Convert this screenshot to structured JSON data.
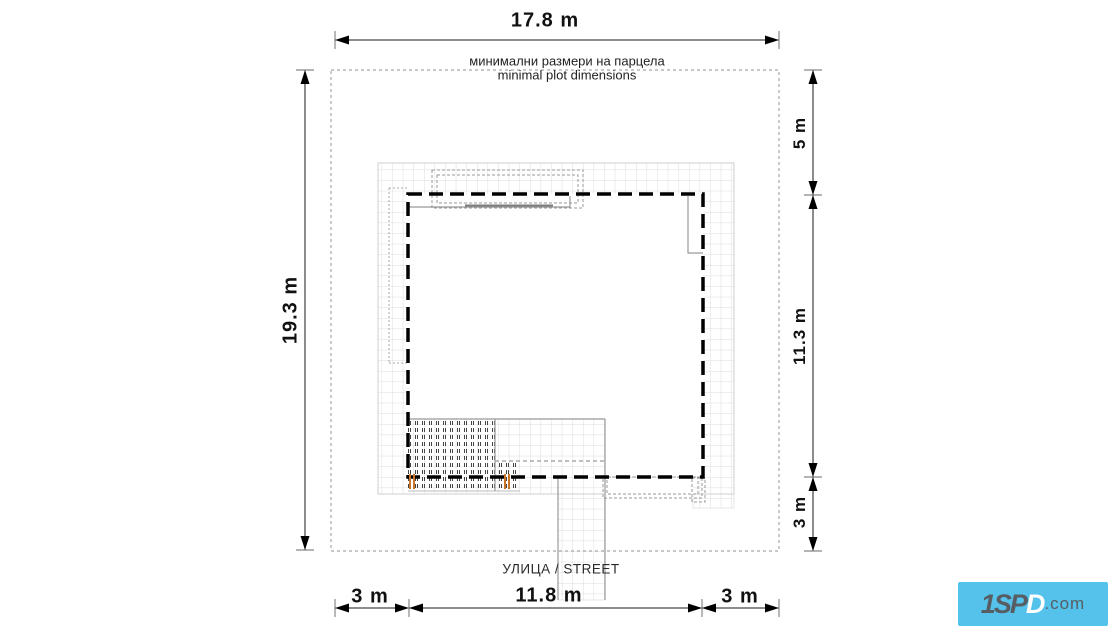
{
  "header": {
    "top_dimension": "17.8 m",
    "note_bg": "минимални размери на парцела",
    "note_en": "minimal plot dimensions"
  },
  "dimensions": {
    "left": "19.3 m",
    "right_top": "5 m",
    "right_middle": "11.3 m",
    "right_bottom": "3 m",
    "bottom_left": "3 m",
    "bottom_middle": "11.8 m",
    "bottom_right": "3 m"
  },
  "street_label": "УЛИЦА / STREET",
  "watermark": {
    "logo_main": "1SP",
    "logo_d": "D",
    "logo_suffix": ".com",
    "bg_color": "#54c2eb",
    "text_color": "#575d63",
    "accent_color": "#ffffff"
  },
  "colors": {
    "envelope_line": "#000000",
    "plot_boundary": "#a8a8a8",
    "grid_line": "#dcdcdc",
    "house_line": "#999999",
    "deck_hatch": "#444444",
    "accent_marks": "#c8762c",
    "dimension_line": "#1a1a1a",
    "dimension_tick": "#888888"
  }
}
